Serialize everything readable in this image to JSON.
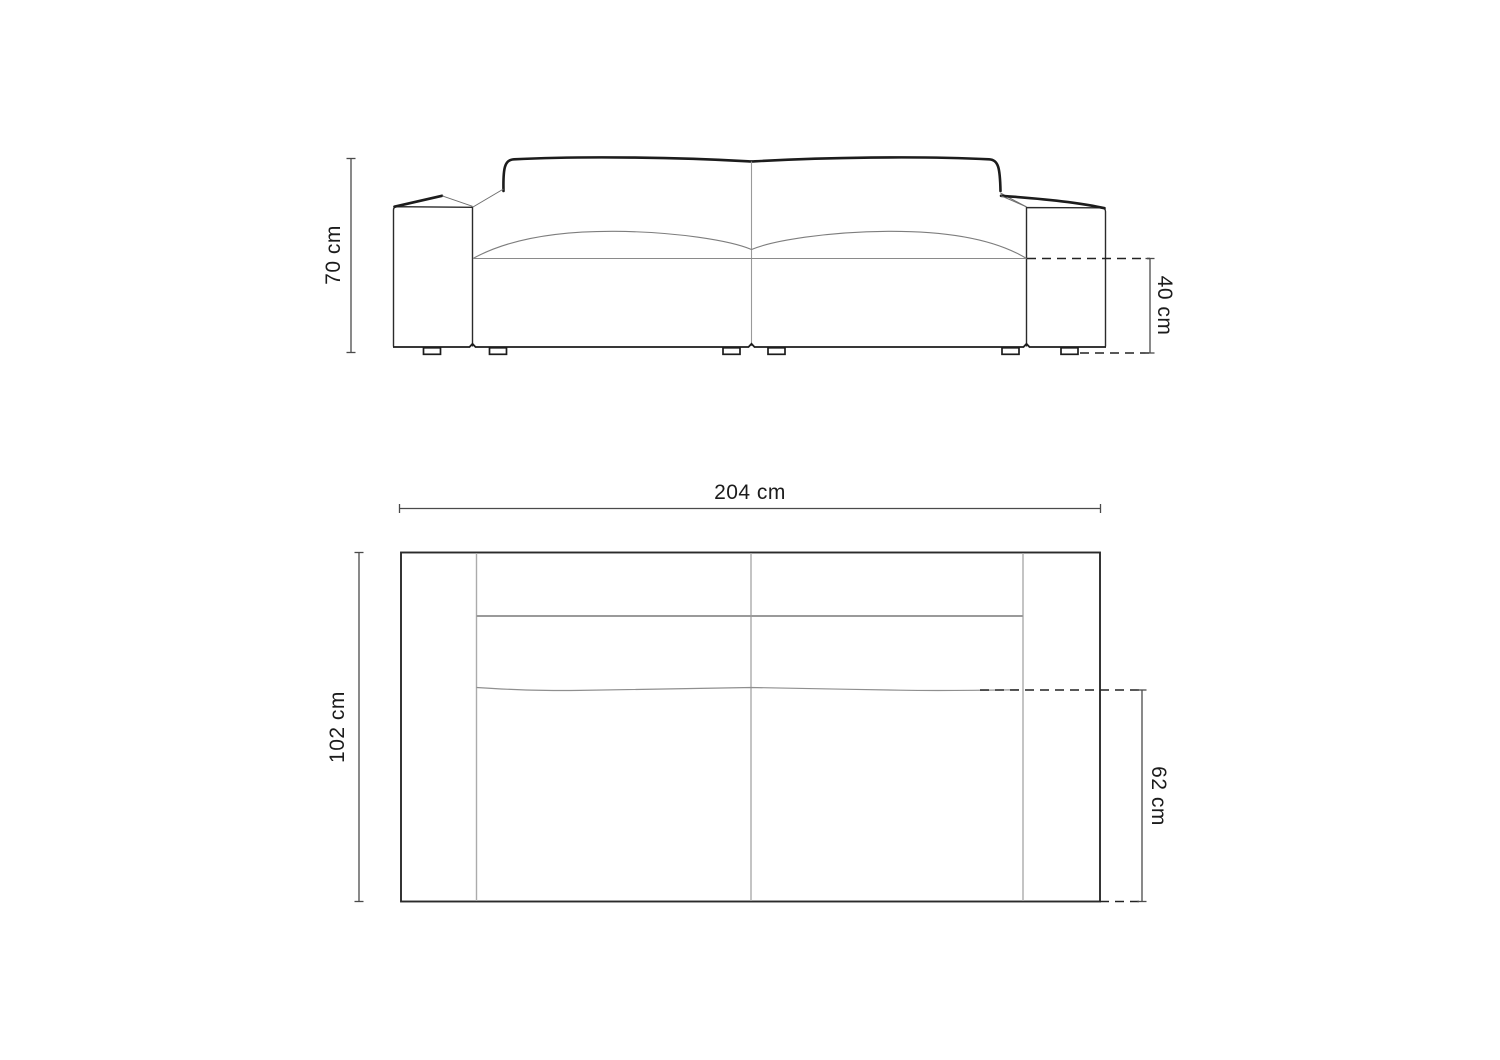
{
  "page": {
    "title": "Sofa dimensions technical drawing",
    "background_color": "#ffffff",
    "outline_color": "#1c1c1c",
    "secondary_line_color": "#9a9a9a",
    "dimension_line_color": "#4a4a4a"
  },
  "front_view": {
    "name": "Sofa front elevation with two seat cushions and block armrests",
    "dimensions": {
      "overall_height": "70 cm",
      "seat_height": "40 cm"
    }
  },
  "top_view": {
    "name": "Sofa plan view (seen from above)",
    "dimensions": {
      "overall_width": "204 cm",
      "overall_depth": "102 cm",
      "seat_depth": "62 cm"
    }
  }
}
